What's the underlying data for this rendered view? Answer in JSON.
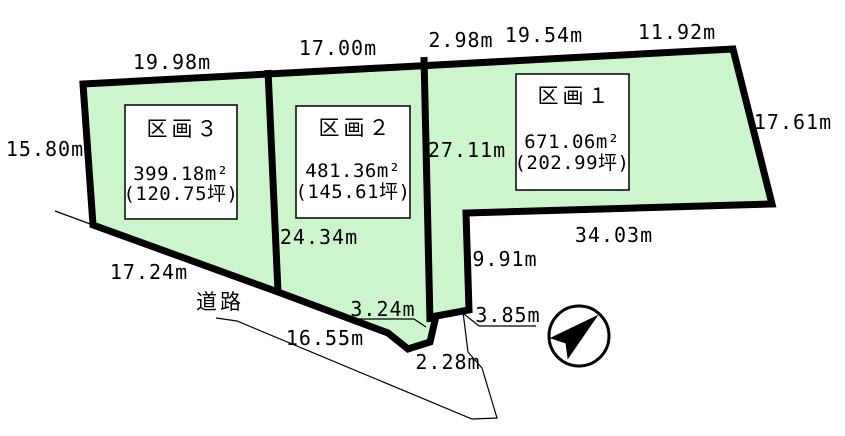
{
  "colors": {
    "parcel_fill": "#ccf5cc",
    "line": "#000000",
    "box_fill": "#ffffff"
  },
  "parcels": [
    {
      "name": "区画１",
      "area": "671.06m²",
      "tsubo": "(202.99坪)"
    },
    {
      "name": "区画２",
      "area": "481.36m²",
      "tsubo": "(145.61坪)"
    },
    {
      "name": "区画３",
      "area": "399.18m²",
      "tsubo": "(120.75坪)"
    }
  ],
  "dimensions": {
    "top_kukaku3": "19.98m",
    "top_kukaku2": "17.00m",
    "top_seg1": "2.98m",
    "top_seg2": "19.54m",
    "top_seg3": "11.92m",
    "right_kukaku1": "17.61m",
    "left_kukaku3": "15.80m",
    "divider_k2_k1": "27.11m",
    "bottom_kukaku1": "34.03m",
    "notch_right": "9.91m",
    "divider_k3_k2": "24.34m",
    "bottom_kukaku3": "17.24m",
    "road_front": "16.55m",
    "bottom_seg_324": "3.24m",
    "notch_bottom": "3.85m",
    "tip_seg": "2.28m"
  },
  "road_label": "道路",
  "icons": {
    "compass": "north-arrow"
  }
}
